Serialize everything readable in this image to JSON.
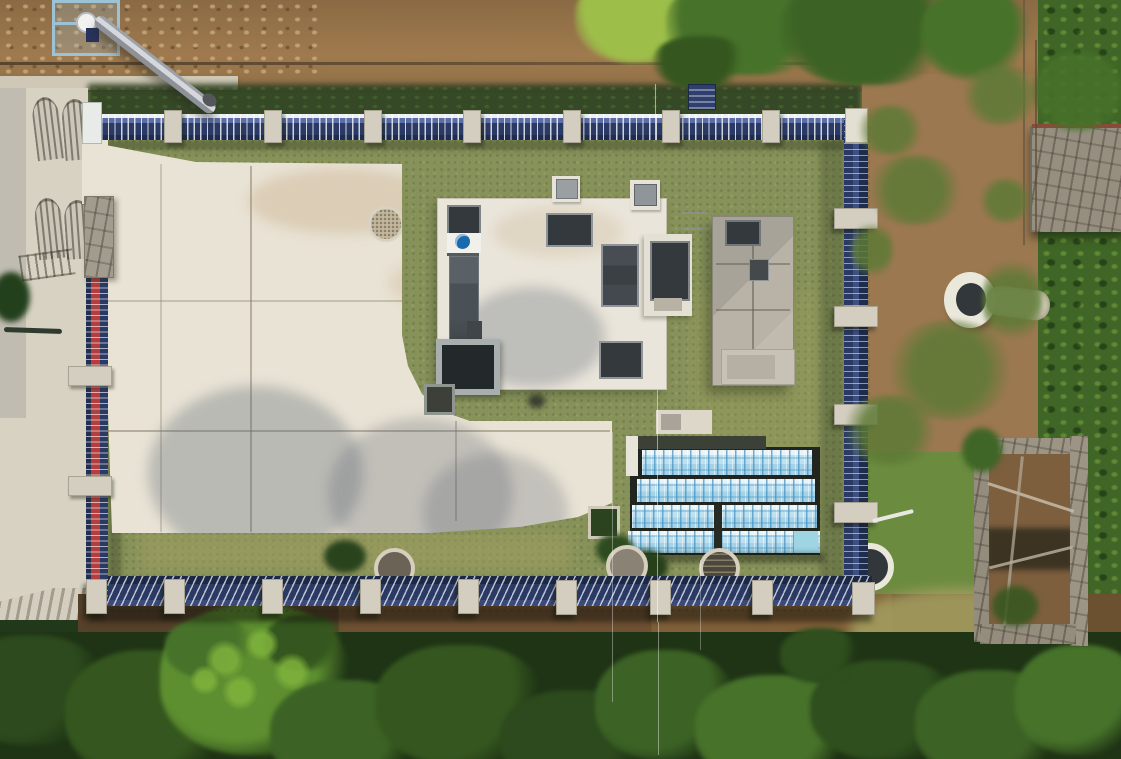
{
  "scene": {
    "domain": "aerial-photograph",
    "description": "Top-down drone photograph of a small rural water-treatment compound: an L-shaped light concrete yard with a rounded inner corner, a white flat-roofed treatment building with dark tanks and an inlet channel bearing a blue circular utility logo, a grey concrete equipment structure, four rows of equipment wrapped in light-blue printed protective film, and round concrete wells. A dark-blue picket perimeter fence with concrete posts encloses lawns; the west run of fence is painted red and blue. Outside lie a concrete walkway with wrought-iron gate shadows, a silver discharge pipe on a slope, bare earth, a stone retaining wall, a collapsed stone hut and dense tree canopy.",
    "lighting": "bright summer daylight, long soft shadows",
    "view": "nadir (straight down)"
  },
  "objects": {
    "perimeter_fence": {
      "label": "blue picket perimeter fence",
      "west_section": "red and blue painted",
      "top_post_count": 8,
      "bottom_post_count": 9
    },
    "treatment_building": {
      "label": "white flat-roof treatment building",
      "tanks": 4,
      "inlet_channel": "dark screen channel with blue logo plate"
    },
    "equipment_building": {
      "label": "grey concrete equipment structure with roof hatch"
    },
    "tarp_array": {
      "label": "equipment rows under blue printed protective film",
      "rows": 4
    },
    "wells": {
      "label": "round concrete wells and manholes",
      "count_inside": 4,
      "count_outside": 1
    },
    "ruin": {
      "label": "collapsed stone hut with exposed beams"
    },
    "pipe": {
      "label": "silver discharge pipe on slope"
    },
    "gates": {
      "label": "wrought-iron entrance gates casting shadows on walkway"
    }
  },
  "colors": {
    "grass_base": "#87925a",
    "grass_dark": "#63763c",
    "grass_dry": "#a3a065",
    "hedge_dark": "#2f4323",
    "soil": "#9c7850",
    "soil_dark": "#75573a",
    "walkway": "#d8d2c3",
    "pad": "#e9e3d5",
    "pad_joint": "#b9b2a0",
    "roof_white": "#eae5da",
    "unit_dark": "#34393d",
    "unit_mid": "#4a5156",
    "unit_frame": "#969c9e",
    "logo_blue": "#1a6ab0",
    "grey_building": "#b0aba0",
    "grey_platform": "#c7c2b5",
    "fence_blue": "#2b3a64",
    "fence_red": "#b43e3e",
    "fence_white": "#edf0f4",
    "post_concrete": "#d3cec0",
    "tarp_light": "#dceef5",
    "tarp_mid": "#abd6e9",
    "tarp_print": "#3f8fc0",
    "tarp_gap": "#20261f",
    "tarp_roof": "#3c4138",
    "tree_dark": "#2c4a1d",
    "tree_mid": "#47722a",
    "tree_bright": "#5d8f30",
    "tree_yellow": "#9dbf4a",
    "forest_base": "#1f3415",
    "stone_wall": "#968f80",
    "pillar_stone": "#a29c8e",
    "pipe_silver": "#c3c6cb",
    "well_ring": "#eae7db",
    "well_center": "#31373a",
    "manhole_ring": "#d6cfbd",
    "ruin_wall": "#9c9484",
    "ruin_debris": "#7d5f3e",
    "platform_blue": "#9cc2d6"
  }
}
